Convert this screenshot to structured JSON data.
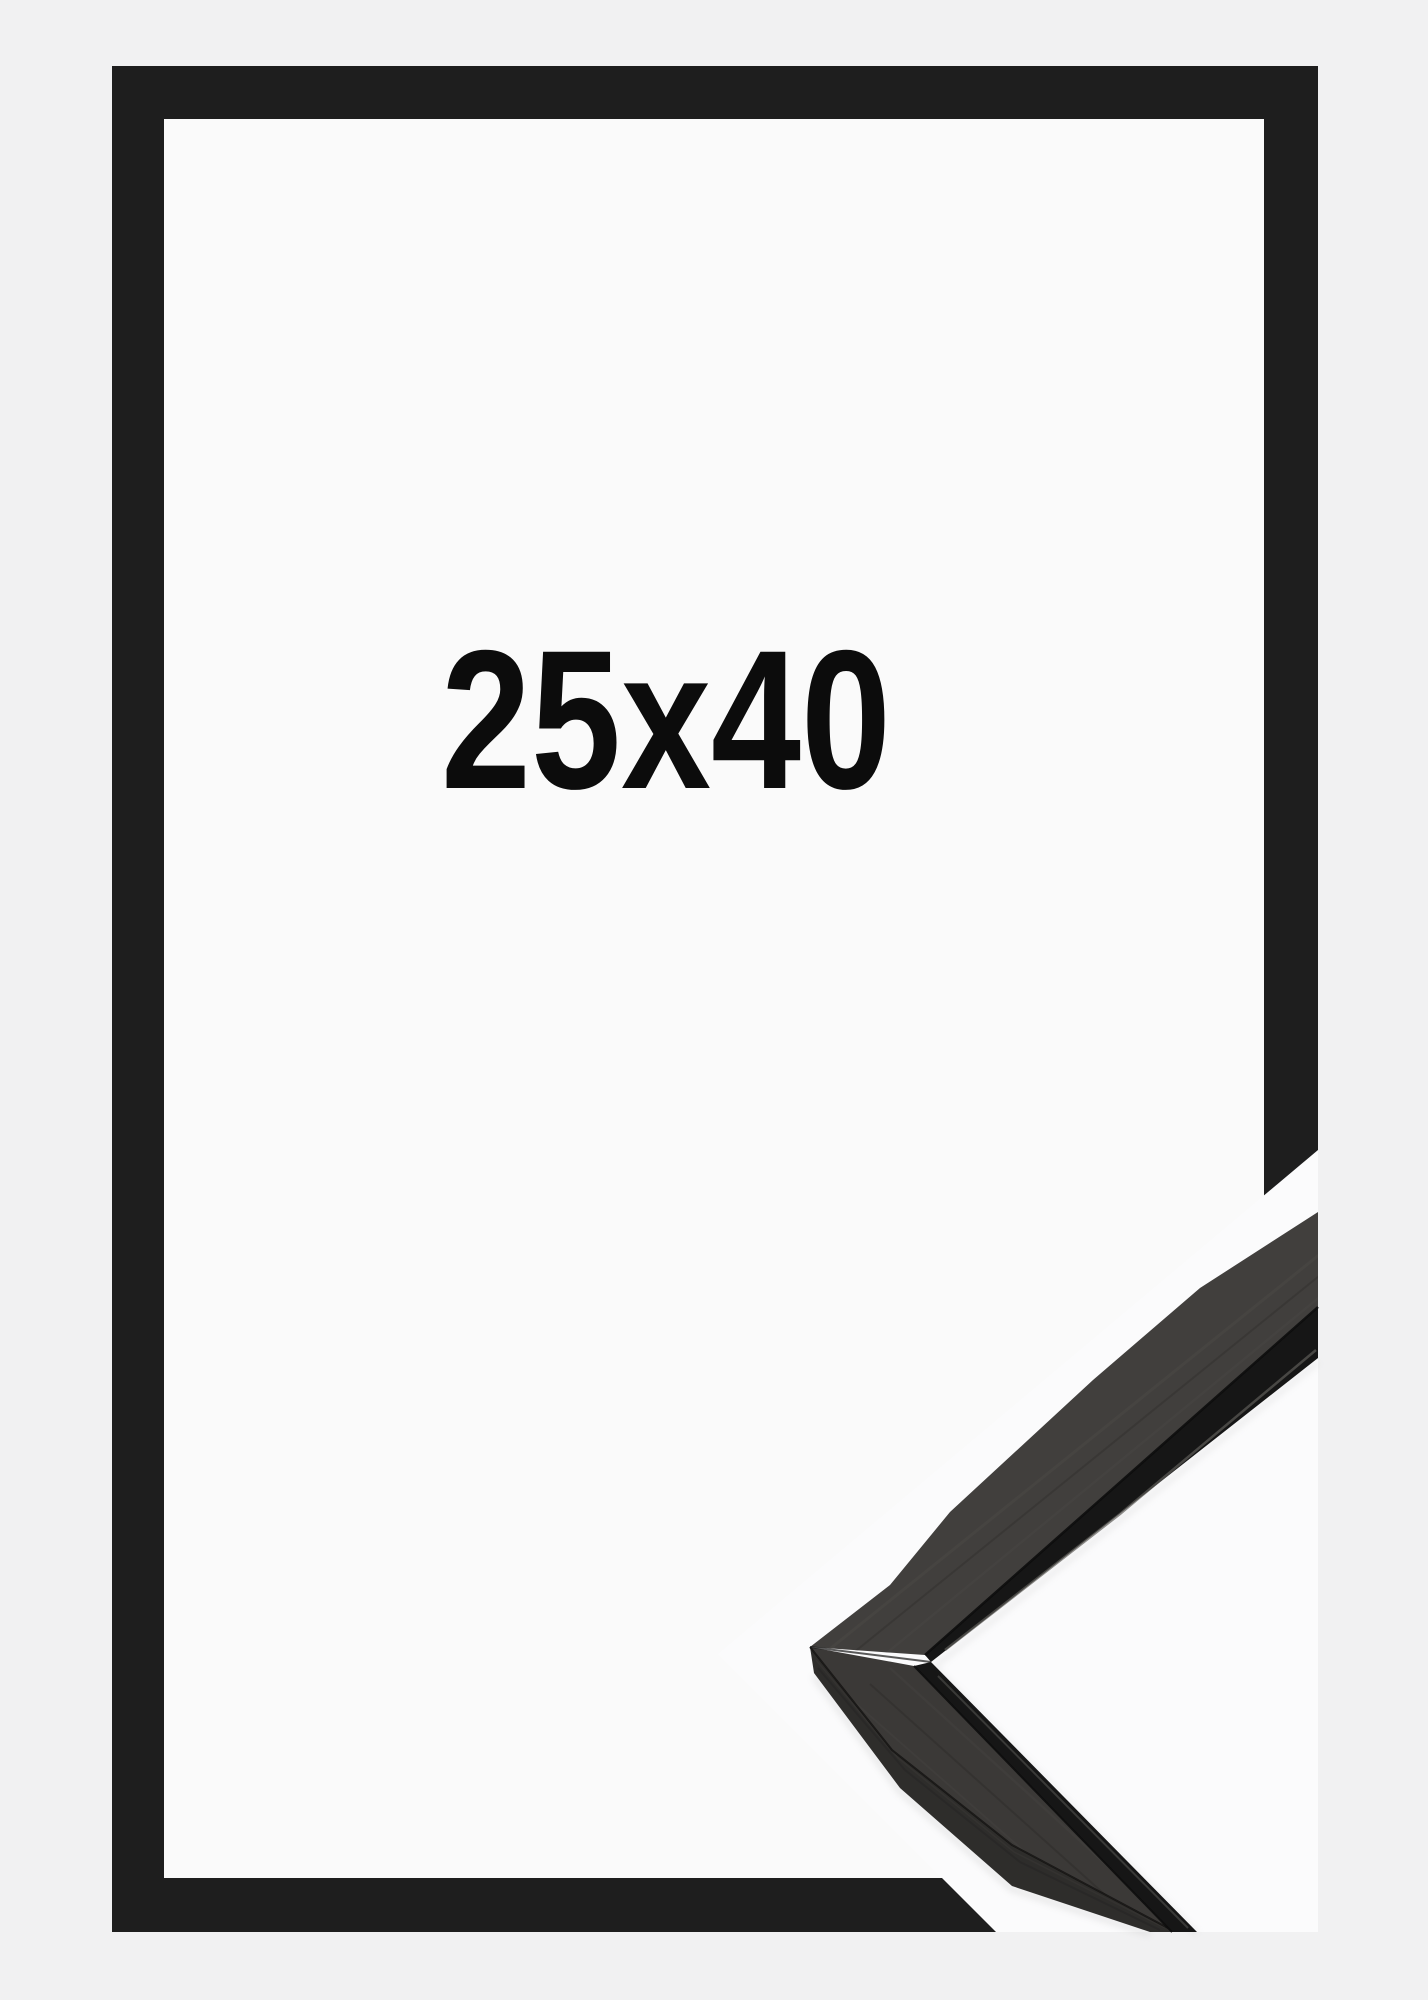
{
  "image": {
    "description": "Product photo of a black picture frame with corner moulding detail",
    "size_label": "25x40",
    "frame_color_name": "black"
  },
  "colors": {
    "background": "#f1f1f2",
    "frame": "#1e1e1e",
    "interior": "#fafafa",
    "photo_background": "#fbfbfc",
    "wood_face_upper": "#413f3d",
    "wood_face_lower": "#3b3937",
    "wood_side": "#2e2d2b",
    "lip": "#161616",
    "text": "#0c0c0c"
  }
}
